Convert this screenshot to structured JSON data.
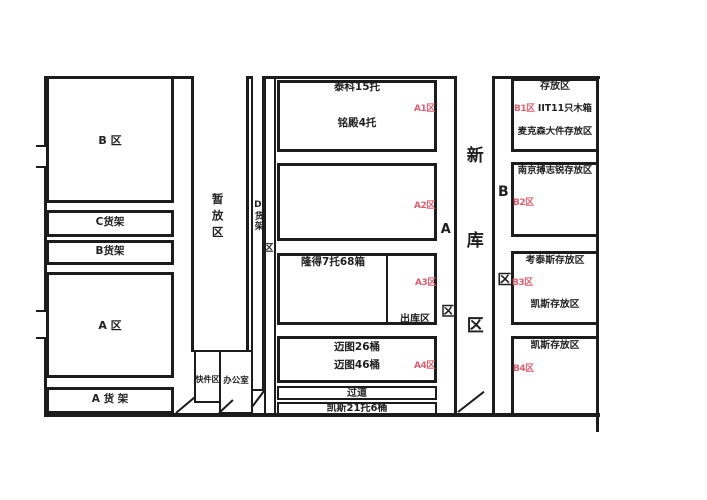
{
  "diagram": {
    "left": {
      "zone_b": "B 区",
      "rack_c": "C货架",
      "rack_b": "B货架",
      "zone_a": "A 区",
      "rack_a": "A 货 架"
    },
    "staging_label": "暂放区",
    "express_label": "快件区",
    "office_label": "办公室",
    "rack_d": "D货架",
    "rack_d_suffix": "区",
    "middle": {
      "a1": {
        "line1": "泰科15托",
        "line2": "铭殿4托",
        "tag": "A1区"
      },
      "a2": {
        "tag": "A2区"
      },
      "a3": {
        "line1": "隆得7托68箱",
        "tag": "A3区",
        "outbound": "出库区"
      },
      "a4": {
        "line1": "迈图26桶",
        "line2": "迈图46桶",
        "tag": "A4区"
      },
      "aisle": "过道",
      "bottom": "凯斯21托6桶"
    },
    "corridor_a": "A区",
    "corridor_b": "B区",
    "new_area": "新库区",
    "right": {
      "b1": {
        "title": "存放区",
        "tag": "B1区",
        "line1": "IIT11只木箱",
        "line2": "麦克森大件存放区"
      },
      "b2": {
        "line1": "南京搏志锐存放区",
        "tag": "B2区"
      },
      "b3": {
        "line1": "考泰斯存放区",
        "tag": "B3区",
        "line2": "凯斯存放区"
      },
      "b4": {
        "line1": "凯斯存放区",
        "tag": "B4区"
      }
    },
    "colors": {
      "line": "#1c1c1c",
      "red_label": "#d95f70",
      "background": "#ffffff"
    }
  }
}
